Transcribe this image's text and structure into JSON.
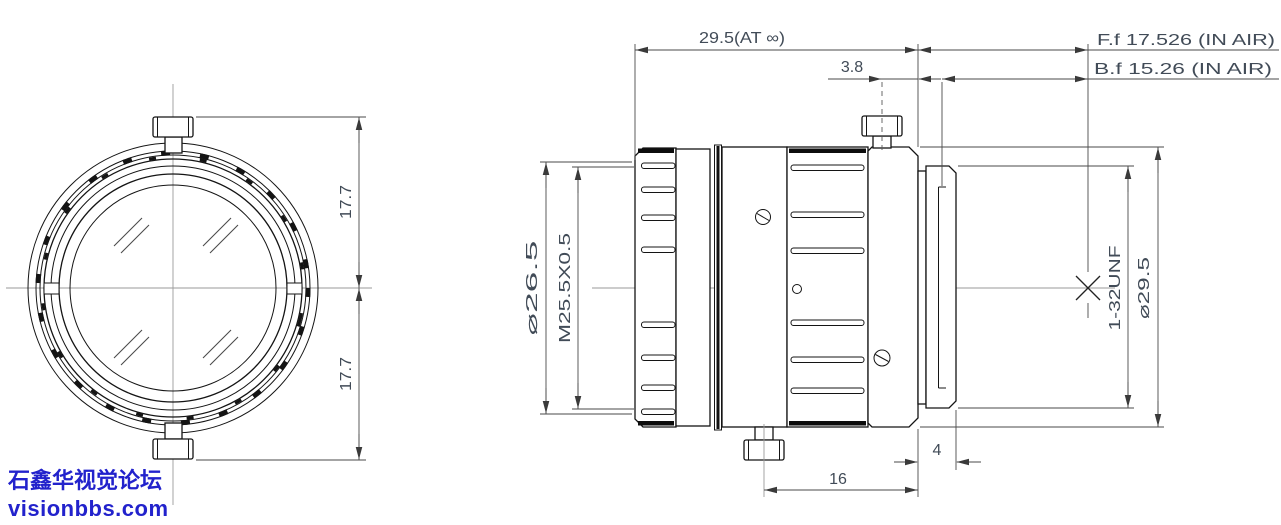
{
  "watermark": {
    "line1": "石鑫华视觉论坛",
    "line2": "visionbbs.com",
    "color": "#2222CC"
  },
  "dims": {
    "total_length": "29.5(AT ∞)",
    "front_focal": "F.f 17.526 (IN AIR)",
    "back_focal": "B.f 15.26  (IN AIR)",
    "screw_to_flange": "3.8",
    "half_height_upper": "17.7",
    "half_height_lower": "17.7",
    "front_diameter": "⌀26.5",
    "filter_thread": "M25.5X0.5",
    "mount_thread": "1-32UNF",
    "body_diameter": "⌀29.5",
    "mount_length": "4",
    "rear_length": "16"
  },
  "colors": {
    "outline": "#141414",
    "dimension_lines": "#4a4a4a",
    "dimension_text": "#414b57",
    "centerline": "#9a9a9a",
    "watermark": "#2222CC"
  }
}
